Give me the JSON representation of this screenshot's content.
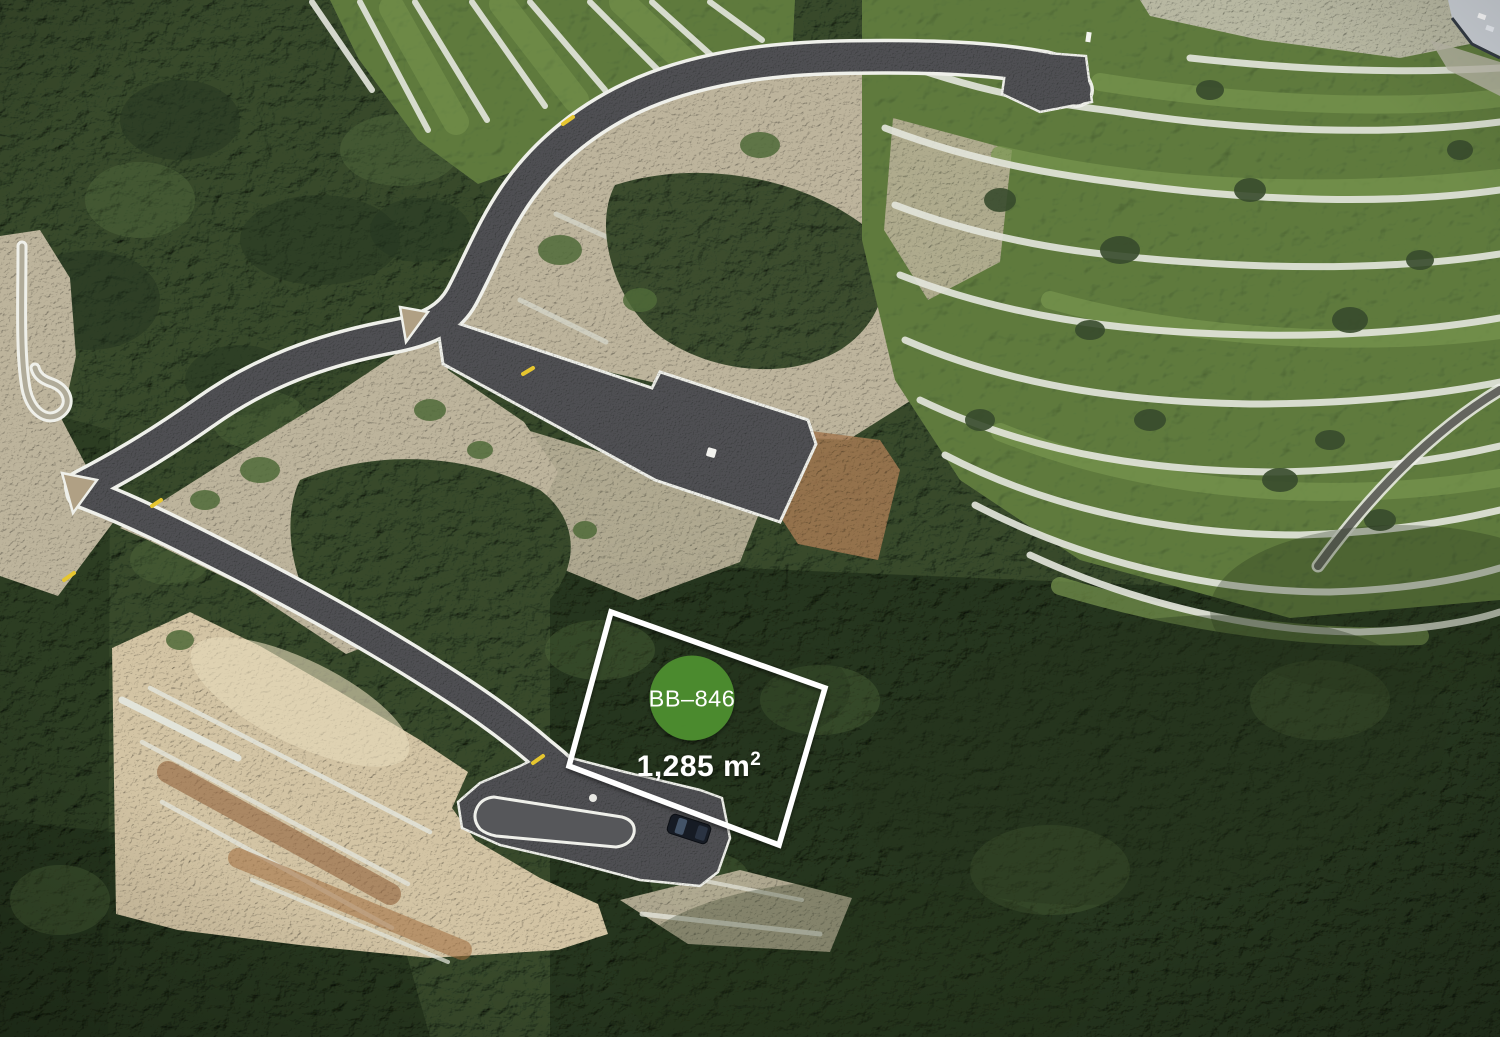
{
  "image": {
    "kind": "aerial-drone-photograph",
    "subject": "Hillside building land with newly built asphalt access roads, guardrails, dry-stone terraces, maquis forest and one marked plot for sale",
    "width_px": 1500,
    "height_px": 1037
  },
  "plot_overlay": {
    "plot_id": "BB–846",
    "area_main": "1,285 m",
    "area_sup": "2",
    "area_full": "1,285 m²"
  },
  "palette": {
    "badge_green": "#4c8c31",
    "boundary_white": "#ffffff",
    "label_white": "#ffffff",
    "asphalt": "#4f5053",
    "guardrail": "#eff0ea",
    "stone_wall": "#e2e4da",
    "reflector_yellow": "#e6c62f",
    "forest_dark": "#374a2c",
    "forest_shadow": "#24331c",
    "terrace_grass": "#5e7a3e",
    "grass_light": "#78954e",
    "bare_rock": "#bdb49c",
    "sand": "#d3c4a4",
    "rust_soil": "#a57a52",
    "car_body": "#161b24"
  }
}
